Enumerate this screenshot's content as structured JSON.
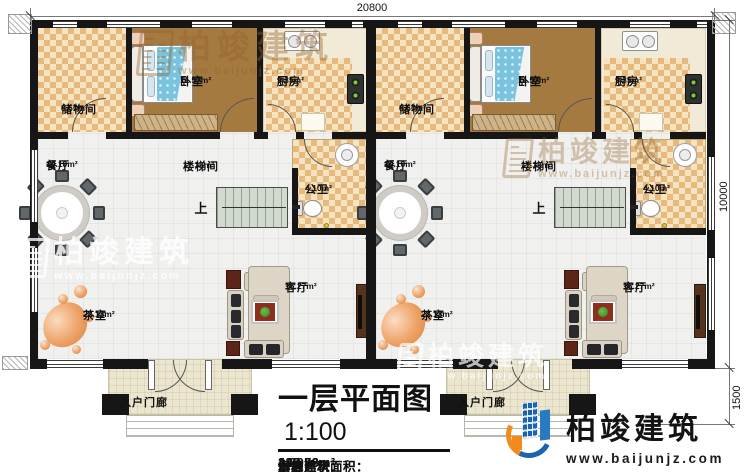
{
  "dimensions": {
    "top": "20800",
    "right_main": "10000",
    "right_lower": "1500"
  },
  "units": [
    {
      "up_label": "上",
      "rooms": {
        "storage": {
          "name": "储物间",
          "area": "9.67m²"
        },
        "bedroom": {
          "name": "卧室",
          "area": "11.57m²"
        },
        "kitchen": {
          "name": "厨房",
          "area": "9.35m²"
        },
        "dining": {
          "name": "餐厅",
          "area": "10.10m²"
        },
        "stair": {
          "name": "楼梯间",
          "area": "11.36m²"
        },
        "bath": {
          "name": "公卫",
          "area": "4.10m²"
        },
        "tea": {
          "name": "茶室",
          "area": "22.13m²"
        },
        "living": {
          "name": "客厅",
          "area": "16.27m²"
        },
        "porch": {
          "name": "入户门廊"
        }
      }
    },
    {
      "up_label": "上",
      "rooms": {
        "storage": {
          "name": "储物间",
          "area": "9.67m²"
        },
        "bedroom": {
          "name": "卧室",
          "area": "11.57m²"
        },
        "kitchen": {
          "name": "厨房",
          "area": "9.35m²"
        },
        "dining": {
          "name": "餐厅",
          "area": "10.10m²"
        },
        "stair": {
          "name": "楼梯间",
          "area": "11.36m²"
        },
        "bath": {
          "name": "公卫",
          "area": "4.10m²"
        },
        "tea": {
          "name": "茶室",
          "area": "22.13m²"
        },
        "living": {
          "name": "客厅",
          "area": "16.27m²"
        },
        "porch": {
          "name": "入户门廊"
        }
      }
    }
  ],
  "titleblock": {
    "title": "一层平面图",
    "scale": "1:100",
    "stats": [
      {
        "label": "本层建筑面积：",
        "value": "222.88m²"
      },
      {
        "label": "本栋建筑面积：",
        "value": "445.76m²"
      },
      {
        "label": "占地面积：",
        "value": "235.33m²"
      },
      {
        "label": "层高：",
        "value": "4.00m"
      }
    ]
  },
  "logo": {
    "name": "柏竣建筑",
    "url": "www.baijunjz.com"
  },
  "watermark": {
    "brand": "柏竣建筑",
    "url": "www.baijunjz.com"
  }
}
